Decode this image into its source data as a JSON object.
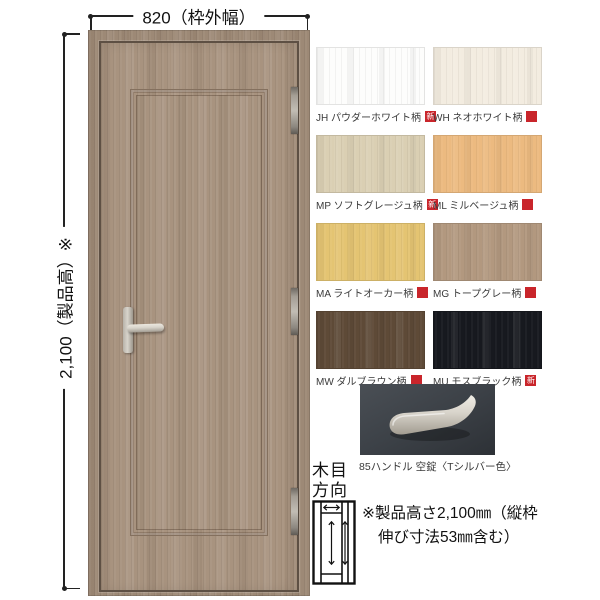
{
  "dimensions": {
    "width_label": "820（枠外幅）",
    "height_label": "2,100（製品高）※"
  },
  "swatches": [
    {
      "code": "JH",
      "label": "JH パウダーホワイト柄",
      "new": true,
      "color": "#fdfdfc"
    },
    {
      "code": "WH",
      "label": "WH ネオホワイト柄",
      "new": false,
      "color": "#f3ece0"
    },
    {
      "code": "MP",
      "label": "MP ソフトグレージュ柄",
      "new": true,
      "color": "#dacfb3"
    },
    {
      "code": "ML",
      "label": "ML ミルベージュ柄",
      "new": false,
      "color": "#ecba80"
    },
    {
      "code": "MA",
      "label": "MA ライトオーカー柄",
      "new": false,
      "color": "#e4c472"
    },
    {
      "code": "MG",
      "label": "MG トープグレー柄",
      "new": false,
      "color": "#b2987f"
    },
    {
      "code": "MW",
      "label": "MW ダルブラウン柄",
      "new": false,
      "color": "#5e4a37"
    },
    {
      "code": "MU",
      "label": "MU モスブラック柄",
      "new": true,
      "color": "#17191f"
    }
  ],
  "badge_label": "新",
  "handle_caption": "85ハンドル 空錠〈Tシルバー色〉",
  "grain_direction": {
    "line1": "木目",
    "line2": "方向"
  },
  "note": {
    "line1": "※製品高さ2,100㎜（縦枠",
    "line2": "伸び寸法53㎜含む）"
  },
  "colors": {
    "door_wood": "#a8937f",
    "frame_wood": "#9d8976",
    "gap": "#5e5044",
    "molding": "#84705e",
    "handle_silver": "#d8d4cb",
    "hinge": "#a49e95",
    "photo_bg_dark": "#33373c",
    "photo_bg_light": "#474c52",
    "badge": "#c9252b",
    "dim_line": "#222222",
    "text": "#111111",
    "label_text": "#3a3a3a"
  }
}
